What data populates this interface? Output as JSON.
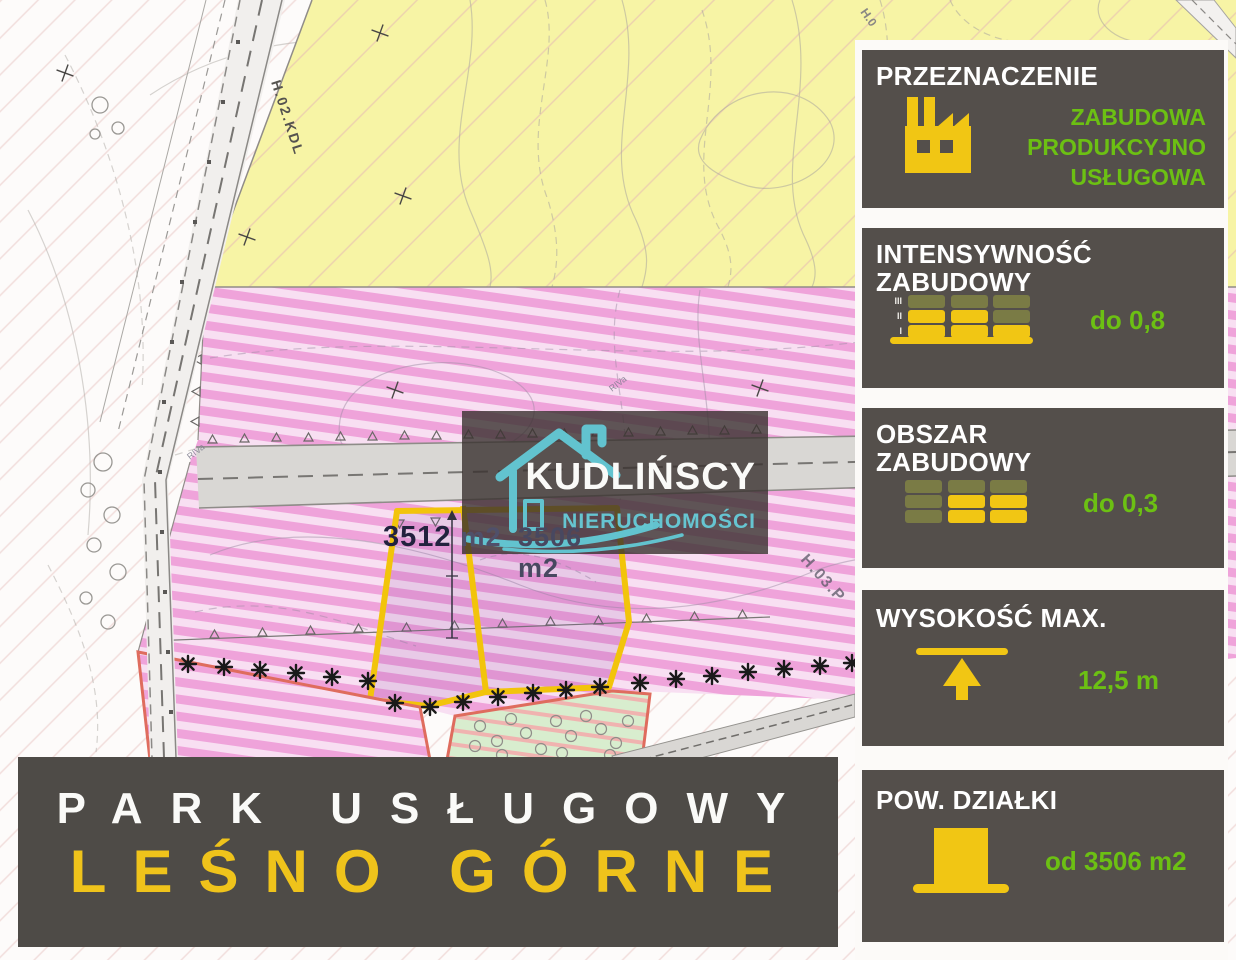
{
  "map": {
    "labels": {
      "road_left": "H.02.KDL",
      "road_top": "H.0",
      "zone": "H.03.P",
      "soil_class_a": "RIVa",
      "soil_class_b": "RIVa",
      "plot1_value": "3512",
      "plot1_unit": "m2",
      "plot2": "3506 m2"
    }
  },
  "watermark": {
    "brand": "KUDLIŃSCY",
    "subtitle": "NIERUCHOMOŚCI"
  },
  "banner": {
    "line1": "PARK USŁUGOWY",
    "line2": "LEŚNO GÓRNE"
  },
  "panels": [
    {
      "title": "PRZEZNACZENIE",
      "icon": "factory-icon",
      "value_lines": [
        "ZABUDOWA",
        "PRODUKCYJNO",
        "USŁUGOWA"
      ]
    },
    {
      "title_line1": "INTENSYWNOŚĆ",
      "title_line2": "ZABUDOWY",
      "icon": "building-levels-icon",
      "levels": [
        "III",
        "II",
        "I"
      ],
      "value": "do 0,8"
    },
    {
      "title_line1": "OBSZAR",
      "title_line2": "ZABUDOWY",
      "icon": "building-footprint-icon",
      "value": "do 0,3"
    },
    {
      "title": "WYSOKOŚĆ MAX.",
      "icon": "max-height-arrow-icon",
      "value": "12,5 m"
    },
    {
      "title": "POW. DZIAŁKI",
      "icon": "plot-block-icon",
      "value": "od 3506 m2"
    }
  ],
  "colors": {
    "accent_yellow": "#F1C614",
    "accent_green": "#6CC013",
    "panel_bg": "#544F4B",
    "teal": "#62C3CF",
    "map_pink": "#EFA3DA",
    "map_yellow": "#F7F4A5",
    "plot_outline": "#F2C40B"
  }
}
